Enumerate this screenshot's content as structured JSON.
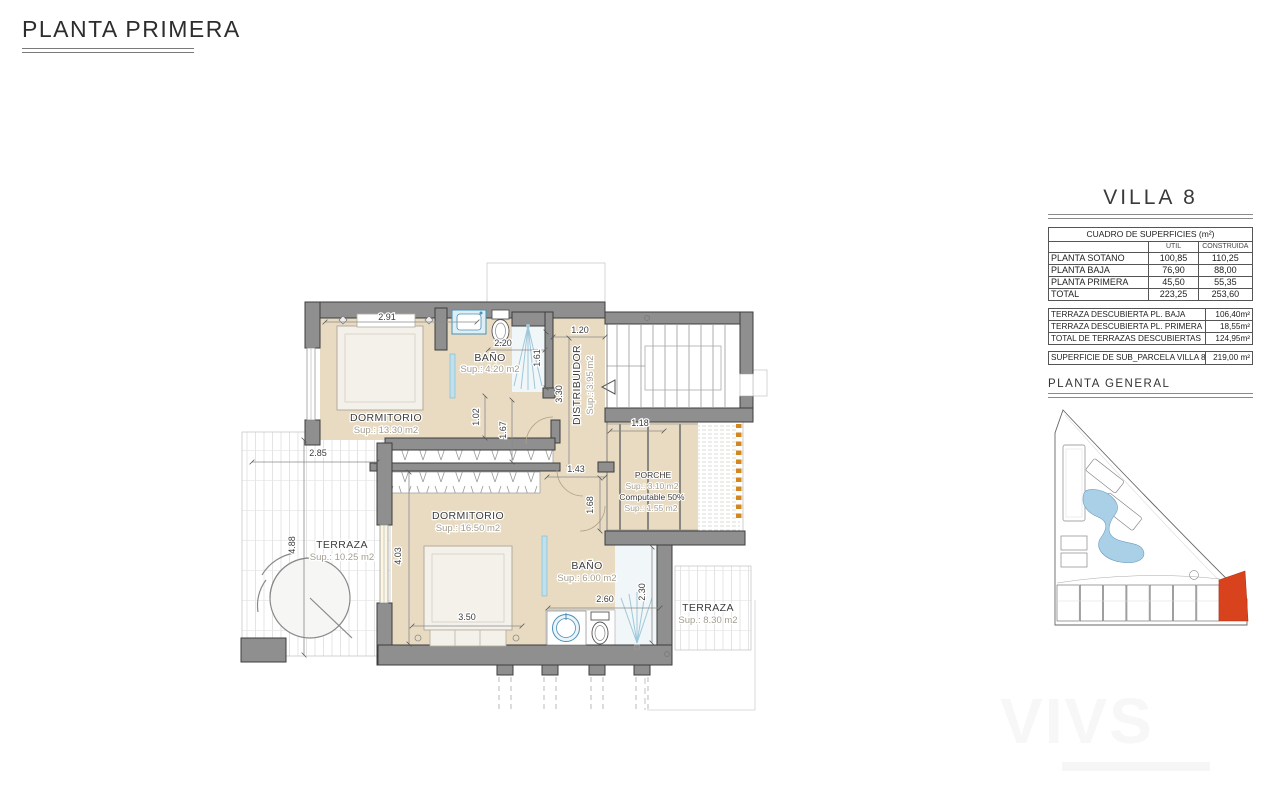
{
  "page": {
    "title": "PLANTA PRIMERA"
  },
  "villa_panel": {
    "title": "VILLA 8",
    "surfaces": {
      "header": "CUADRO DE SUPERFICIES (m²)",
      "col_util": "UTIL",
      "col_construida": "CONSTRUIDA",
      "rows": [
        {
          "label": "PLANTA SOTANO",
          "util": "100,85",
          "construida": "110,25"
        },
        {
          "label": "PLANTA BAJA",
          "util": "76,90",
          "construida": "88,00"
        },
        {
          "label": "PLANTA PRIMERA",
          "util": "45,50",
          "construida": "55,35"
        },
        {
          "label": "TOTAL",
          "util": "223,25",
          "construida": "253,60"
        }
      ]
    },
    "terraces": [
      {
        "label": "TERRAZA DESCUBIERTA PL. BAJA",
        "value": "106,40m²"
      },
      {
        "label": "TERRAZA DESCUBIERTA PL. PRIMERA",
        "value": "18,55m²"
      },
      {
        "label": "TOTAL DE TERRAZAS DESCUBIERTAS",
        "value": "124,95m²"
      }
    ],
    "parcel": {
      "label": "SUPERFICIE DE SUB_PARCELA VILLA 8",
      "value": "219,00 m²"
    },
    "site_plan_title": "PLANTA GENERAL"
  },
  "plan": {
    "rooms": {
      "dorm1": {
        "name": "DORMITORIO",
        "sup": "Sup.: 13.30 m2"
      },
      "bath1": {
        "name": "BAÑO",
        "sup": "Sup.: 4.20 m2"
      },
      "distribuidor": {
        "name": "DISTRIBUIDOR",
        "sup": "Sup.: 3.95 m2"
      },
      "dorm2": {
        "name": "DORMITORIO",
        "sup": "Sup.: 16.50 m2"
      },
      "bath2": {
        "name": "BAÑO",
        "sup": "Sup.: 6.00 m2"
      },
      "terraza_left": {
        "name": "TERRAZA",
        "sup": "Sup.: 10.25 m2"
      },
      "terraza_right": {
        "name": "TERRAZA",
        "sup": "Sup.: 8.30 m2"
      },
      "porche": {
        "name": "PORCHE",
        "sup": "Sup.: 3.10 m2",
        "note": "Computable 50%",
        "sup2": "Sup.: 1.55 m2"
      }
    },
    "dims": {
      "d291": "2.91",
      "d220": "2.20",
      "d120": "1.20",
      "d161": "1.61",
      "d330": "3.30",
      "d102": "1.02",
      "d167": "1.67",
      "d285": "2.85",
      "d488": "4.88",
      "d143": "1.43",
      "d118": "1.18",
      "d168": "1.68",
      "d403": "4.03",
      "d350": "3.50",
      "d260": "2.60",
      "d230": "2.30"
    }
  },
  "watermark": "VIVS",
  "colors": {
    "floor": "#e8dbc2",
    "wall": "#8f8f8f",
    "highlight": "#d8431e",
    "pool": "#a9d0e6",
    "fixture_blue": "#4a90b8",
    "hatch_orange": "#d4861f"
  }
}
